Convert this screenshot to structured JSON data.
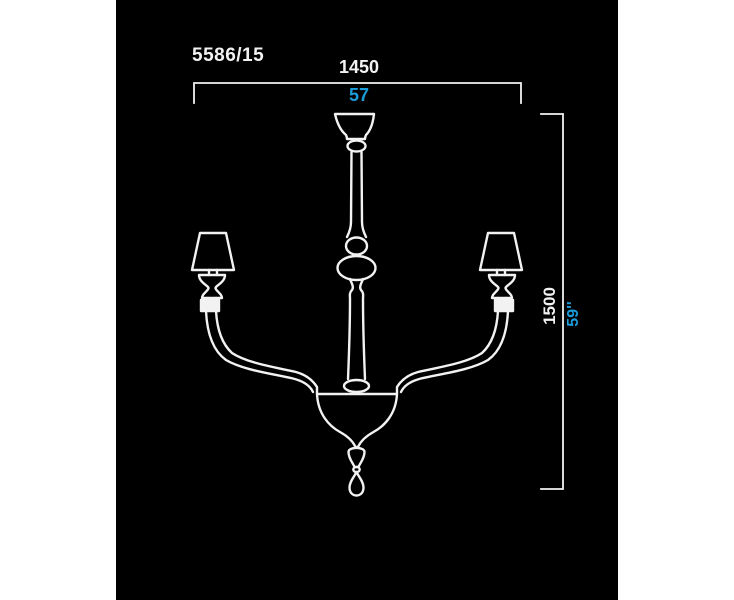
{
  "page": {
    "background_color": "#ffffff"
  },
  "drawing": {
    "model_number": "5586/15",
    "width_dimension": {
      "millimeters": "1450",
      "inches": "57"
    },
    "height_dimension": {
      "millimeters": "1500",
      "inches": "59''"
    },
    "colors": {
      "canvas_background": "#000000",
      "line": "#f2f2f2",
      "metric_label": "#f2f2f2",
      "imperial_label": "#1b9dd9"
    },
    "subject": "two-arm chandelier technical drawing"
  }
}
